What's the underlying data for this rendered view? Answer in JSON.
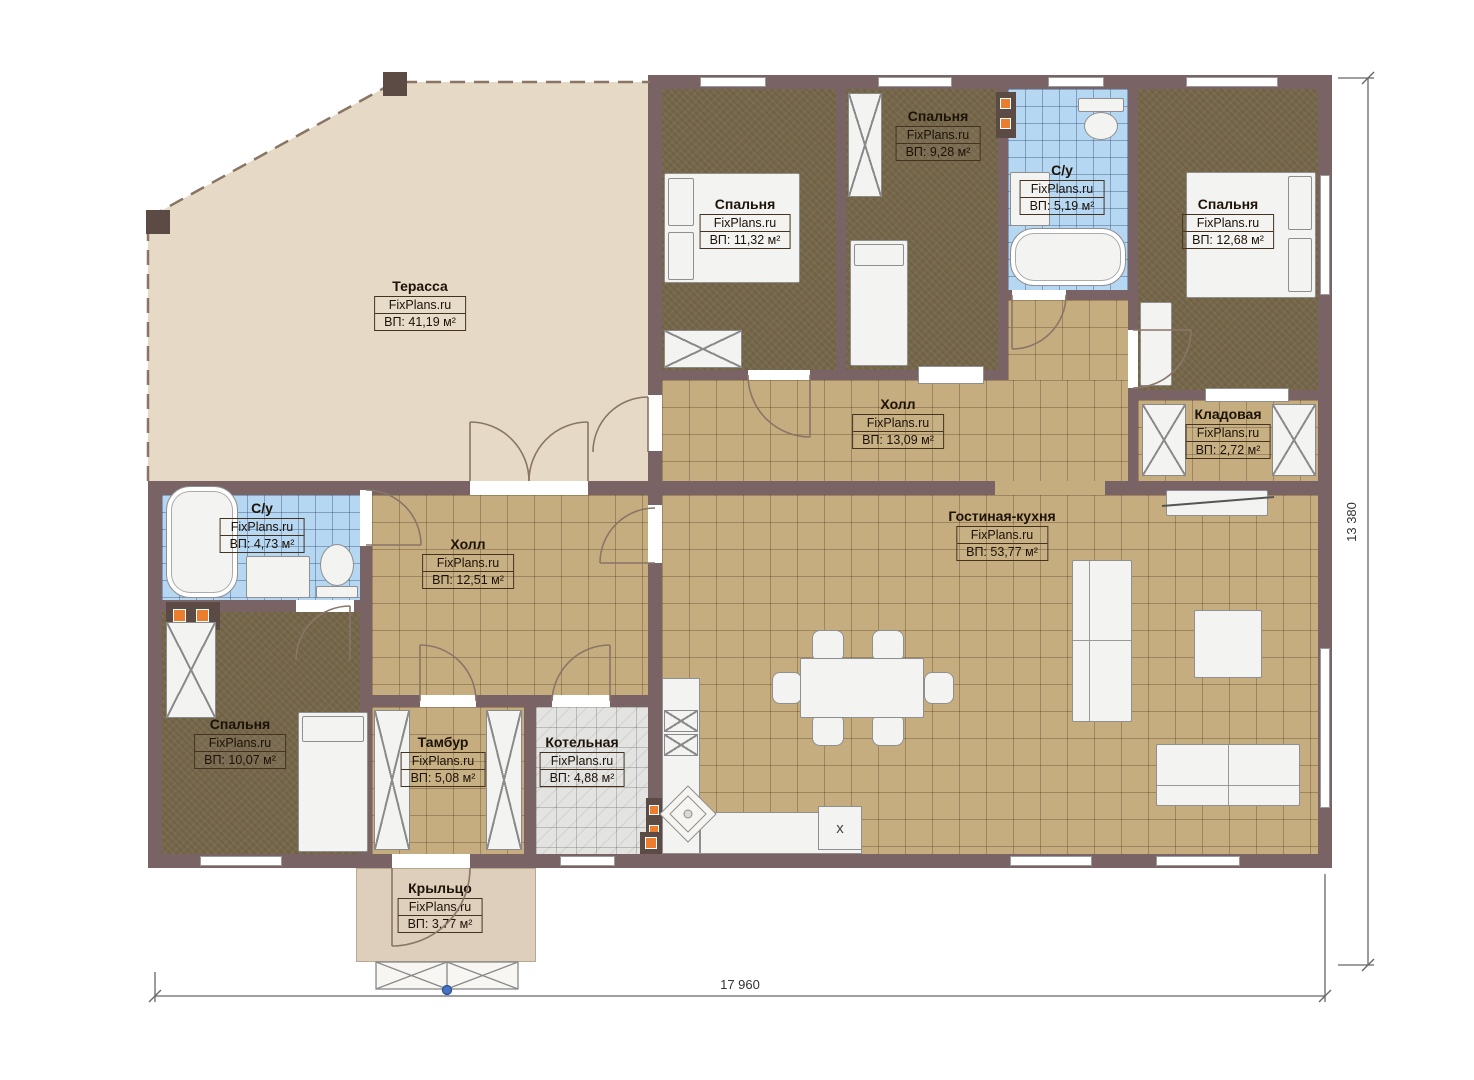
{
  "brand": "FixPlans.ru",
  "rooms": [
    {
      "name": "Терасса",
      "brand": "FixPlans.ru",
      "area": "ВП: 41,19 м²"
    },
    {
      "name": "Спальня",
      "brand": "FixPlans.ru",
      "area": "ВП: 11,32 м²"
    },
    {
      "name": "Спальня",
      "brand": "FixPlans.ru",
      "area": "ВП: 9,28 м²"
    },
    {
      "name": "С/у",
      "brand": "FixPlans.ru",
      "area": "ВП: 5,19 м²"
    },
    {
      "name": "Спальня",
      "brand": "FixPlans.ru",
      "area": "ВП: 12,68 м²"
    },
    {
      "name": "Холл",
      "brand": "FixPlans.ru",
      "area": "ВП: 13,09 м²"
    },
    {
      "name": "Кладовая",
      "brand": "FixPlans.ru",
      "area": "ВП: 2,72 м²"
    },
    {
      "name": "С/у",
      "brand": "FixPlans.ru",
      "area": "ВП: 4,73 м²"
    },
    {
      "name": "Холл",
      "brand": "FixPlans.ru",
      "area": "ВП: 12,51 м²"
    },
    {
      "name": "Гостиная-кухня",
      "brand": "FixPlans.ru",
      "area": "ВП: 53,77 м²"
    },
    {
      "name": "Спальня",
      "brand": "FixPlans.ru",
      "area": "ВП: 10,07 м²"
    },
    {
      "name": "Тамбур",
      "brand": "FixPlans.ru",
      "area": "ВП: 5,08 м²"
    },
    {
      "name": "Котельная",
      "brand": "FixPlans.ru",
      "area": "ВП: 4,88 м²"
    },
    {
      "name": "Крыльцо",
      "brand": "FixPlans.ru",
      "area": "ВП: 3,77 м²"
    }
  ],
  "dimensions": {
    "width": "17 960",
    "height": "13 380"
  },
  "markers": {
    "stove": "x"
  },
  "colors": {
    "wall": "#796364",
    "tile": "#c5ad7f",
    "bedroom_floor": "#77684b",
    "bath_tile": "#b5d7f2",
    "terrace": "#e6dac7",
    "porch": "#ddcfbb",
    "boiler_tile": "#e3e3e1",
    "vent_accent": "#ea7e2e",
    "step_marker": "#4472c4"
  }
}
